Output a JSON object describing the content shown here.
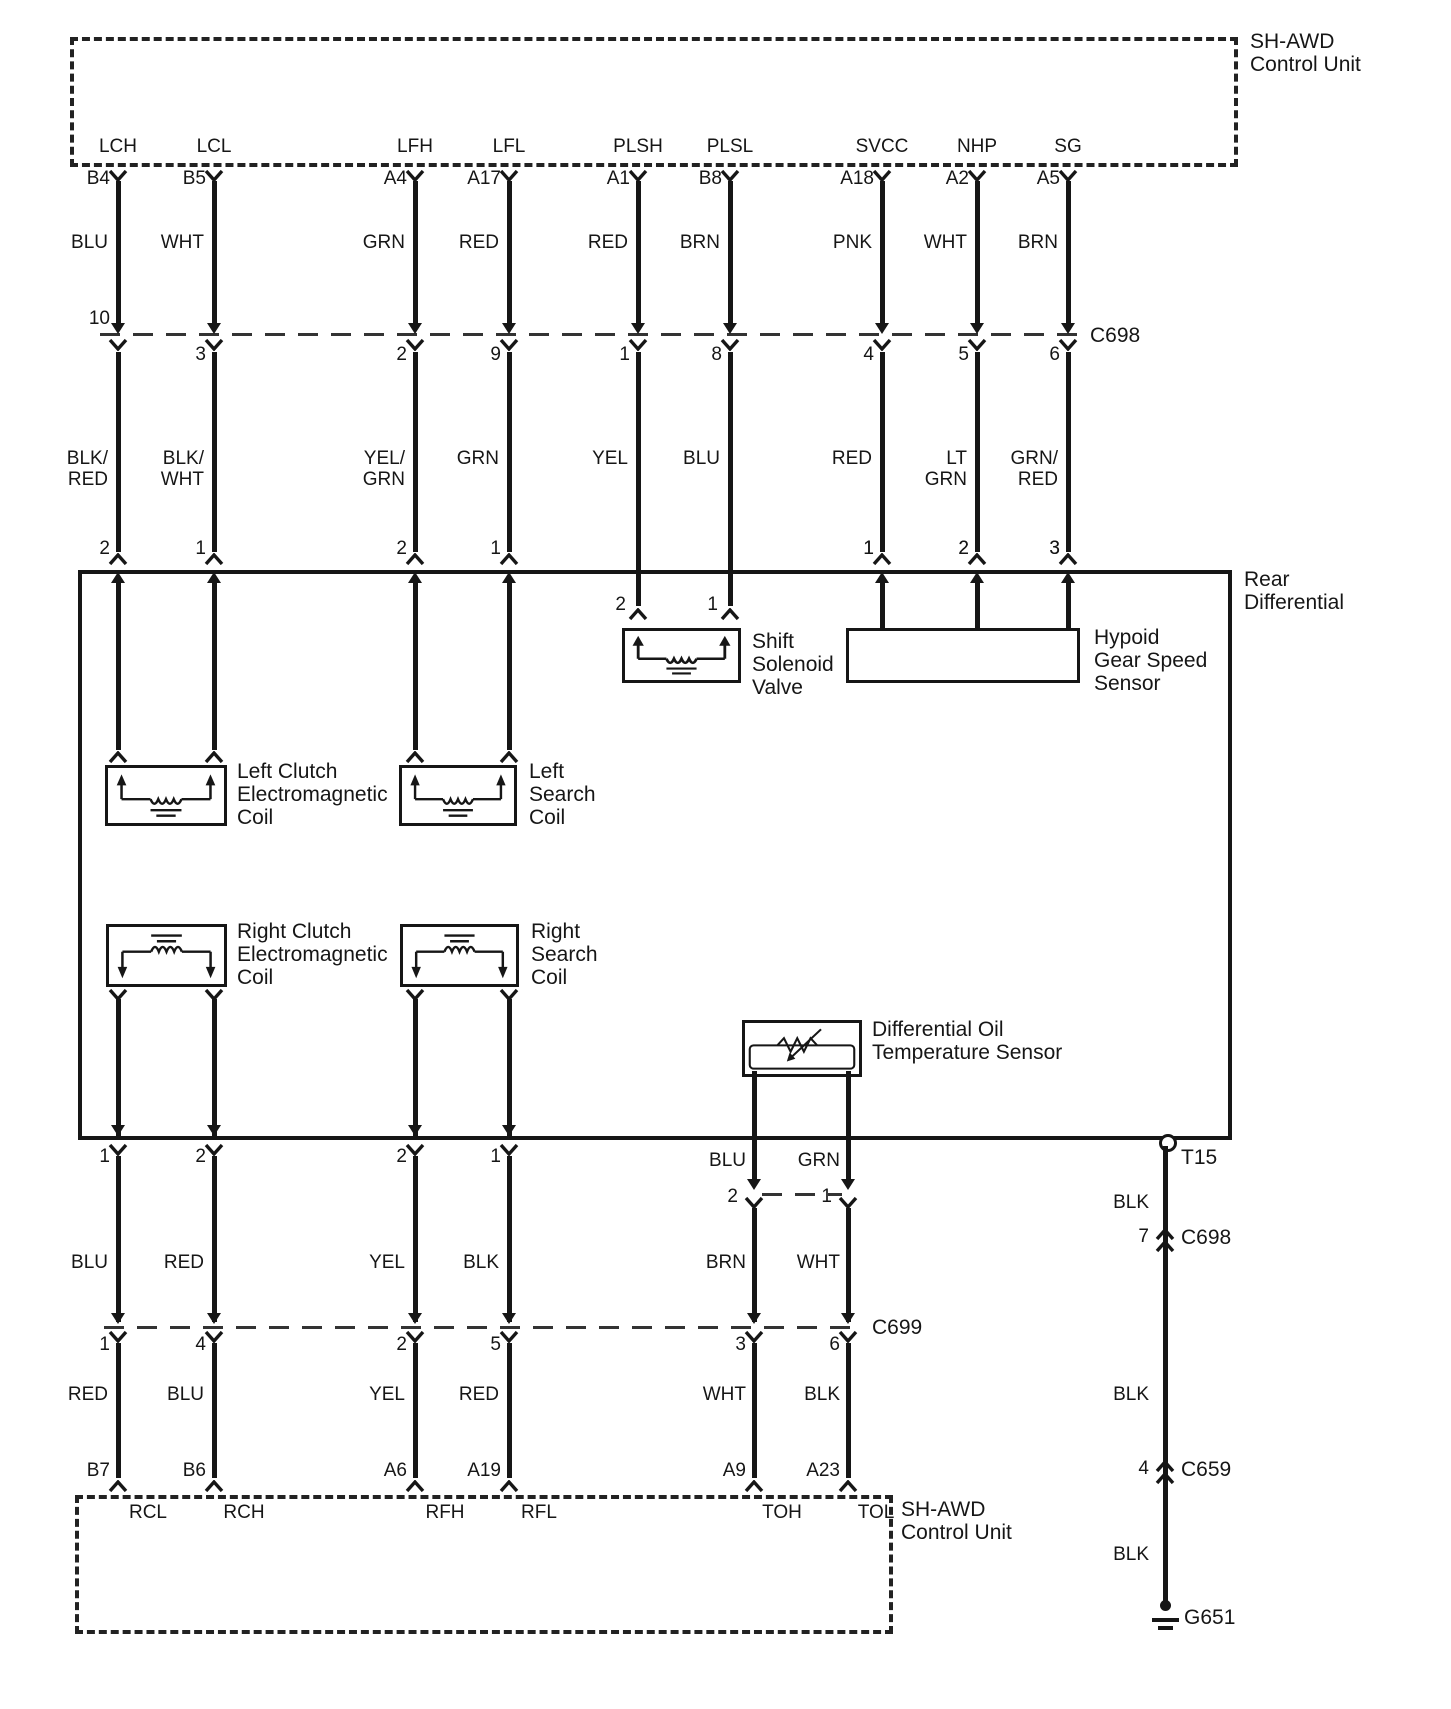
{
  "titles": {
    "top_unit": "SH-AWD\nControl Unit",
    "bottom_unit": "SH-AWD\nControl Unit",
    "rear_diff": "Rear\nDifferential"
  },
  "connectors": {
    "c698_top": "C698",
    "c699": "C699",
    "t15": "T15",
    "c698_mid": "C698",
    "c698_mid_pin": "7",
    "c659": "C659",
    "c659_pin": "4",
    "g651": "G651",
    "ground_colors": [
      "BLK",
      "BLK",
      "BLK"
    ]
  },
  "components": {
    "shift_solenoid": {
      "name": "Shift\nSolenoid\nValve",
      "pins": [
        "2",
        "1"
      ]
    },
    "hypoid": {
      "name": "Hypoid\nGear Speed\nSensor",
      "pins": [
        "1",
        "2",
        "3"
      ]
    },
    "left_clutch": {
      "name": "Left Clutch\nElectromagnetic\nCoil"
    },
    "left_search": {
      "name": "Left\nSearch\nCoil"
    },
    "right_clutch": {
      "name": "Right Clutch\nElectromagnetic\nCoil"
    },
    "right_search": {
      "name": "Right\nSearch\nCoil"
    },
    "oil_temp": {
      "name": "Differential Oil\nTemperature Sensor",
      "pins": [
        "2",
        "1"
      ],
      "wire_colors": [
        "BLU",
        "GRN"
      ]
    }
  },
  "top_columns": [
    {
      "port": "LCH",
      "pin": "B4",
      "color_upper": "BLU",
      "c698_pin": "10",
      "color_lower": "BLK/\nRED",
      "diff_pin": "2"
    },
    {
      "port": "LCL",
      "pin": "B5",
      "color_upper": "WHT",
      "c698_pin": "3",
      "color_lower": "BLK/\nWHT",
      "diff_pin": "1"
    },
    {
      "port": "LFH",
      "pin": "A4",
      "color_upper": "GRN",
      "c698_pin": "2",
      "color_lower": "YEL/\nGRN",
      "diff_pin": "2"
    },
    {
      "port": "LFL",
      "pin": "A17",
      "color_upper": "RED",
      "c698_pin": "9",
      "color_lower": "GRN",
      "diff_pin": "1"
    },
    {
      "port": "PLSH",
      "pin": "A1",
      "color_upper": "RED",
      "c698_pin": "1",
      "color_lower": "YEL",
      "diff_pin": "2"
    },
    {
      "port": "PLSL",
      "pin": "B8",
      "color_upper": "BRN",
      "c698_pin": "8",
      "color_lower": "BLU",
      "diff_pin": "1"
    },
    {
      "port": "SVCC",
      "pin": "A18",
      "color_upper": "PNK",
      "c698_pin": "4",
      "color_lower": "RED",
      "diff_pin": "1"
    },
    {
      "port": "NHP",
      "pin": "A2",
      "color_upper": "WHT",
      "c698_pin": "5",
      "color_lower": "LT\nGRN",
      "diff_pin": "2"
    },
    {
      "port": "SG",
      "pin": "A5",
      "color_upper": "BRN",
      "c698_pin": "6",
      "color_lower": "GRN/\nRED",
      "diff_pin": "3"
    }
  ],
  "bottom_columns": [
    {
      "diff_pin": "1",
      "color_upper": "BLU",
      "c699_pin": "1",
      "color_lower": "RED",
      "pin": "B7",
      "port": "RCL"
    },
    {
      "diff_pin": "2",
      "color_upper": "RED",
      "c699_pin": "4",
      "color_lower": "BLU",
      "pin": "B6",
      "port": "RCH"
    },
    {
      "diff_pin": "2",
      "color_upper": "YEL",
      "c699_pin": "2",
      "color_lower": "YEL",
      "pin": "A6",
      "port": "RFH"
    },
    {
      "diff_pin": "1",
      "color_upper": "BLK",
      "c699_pin": "5",
      "color_lower": "RED",
      "pin": "A19",
      "port": "RFL"
    },
    {
      "sensor_color": "BLU",
      "sensor_pin": "2",
      "color_upper": "BRN",
      "c699_pin": "3",
      "color_lower": "WHT",
      "pin": "A9",
      "port": "TOH"
    },
    {
      "sensor_color": "GRN",
      "sensor_pin": "1",
      "color_upper": "WHT",
      "c699_pin": "6",
      "color_lower": "BLK",
      "pin": "A23",
      "port": "TOL"
    }
  ],
  "colors": {
    "ink": "#161616",
    "paper": "#ffffff"
  }
}
